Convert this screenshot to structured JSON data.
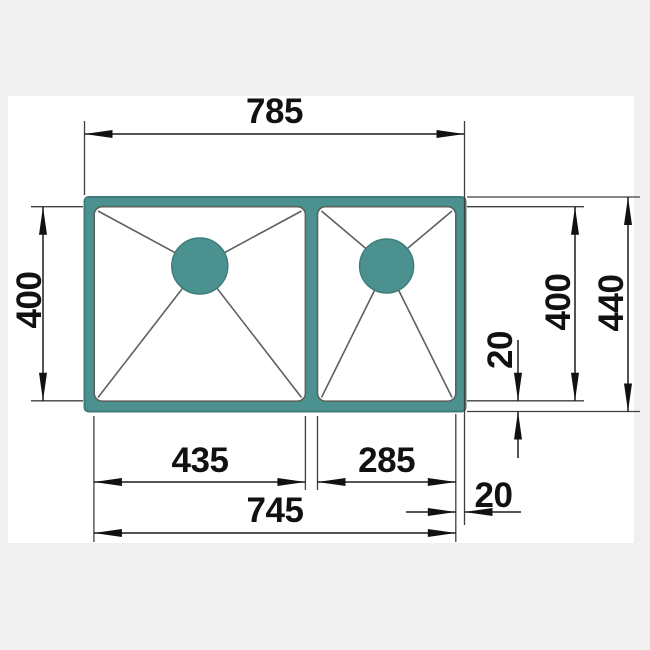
{
  "meta": {
    "description": "Technical dimension drawing of a double-bowl kitchen sink, top view",
    "unit": "mm"
  },
  "colors": {
    "page_background": "#f0f0f0",
    "canvas_background": "#ffffff",
    "sink_fill": "#4a9190",
    "sink_edge": "#3e7d7c",
    "outline_gray": "#5d615e",
    "dimension_black": "#111111"
  },
  "labels": {
    "overall_width": "785",
    "left_bowl_depth": "400",
    "right_bowl_depth": "400",
    "overall_depth": "440",
    "right_edge_gap": "20",
    "left_bowl_width": "435",
    "right_bowl_width": "285",
    "bowls_overall_width": "745",
    "bottom_edge_gap": "20"
  }
}
